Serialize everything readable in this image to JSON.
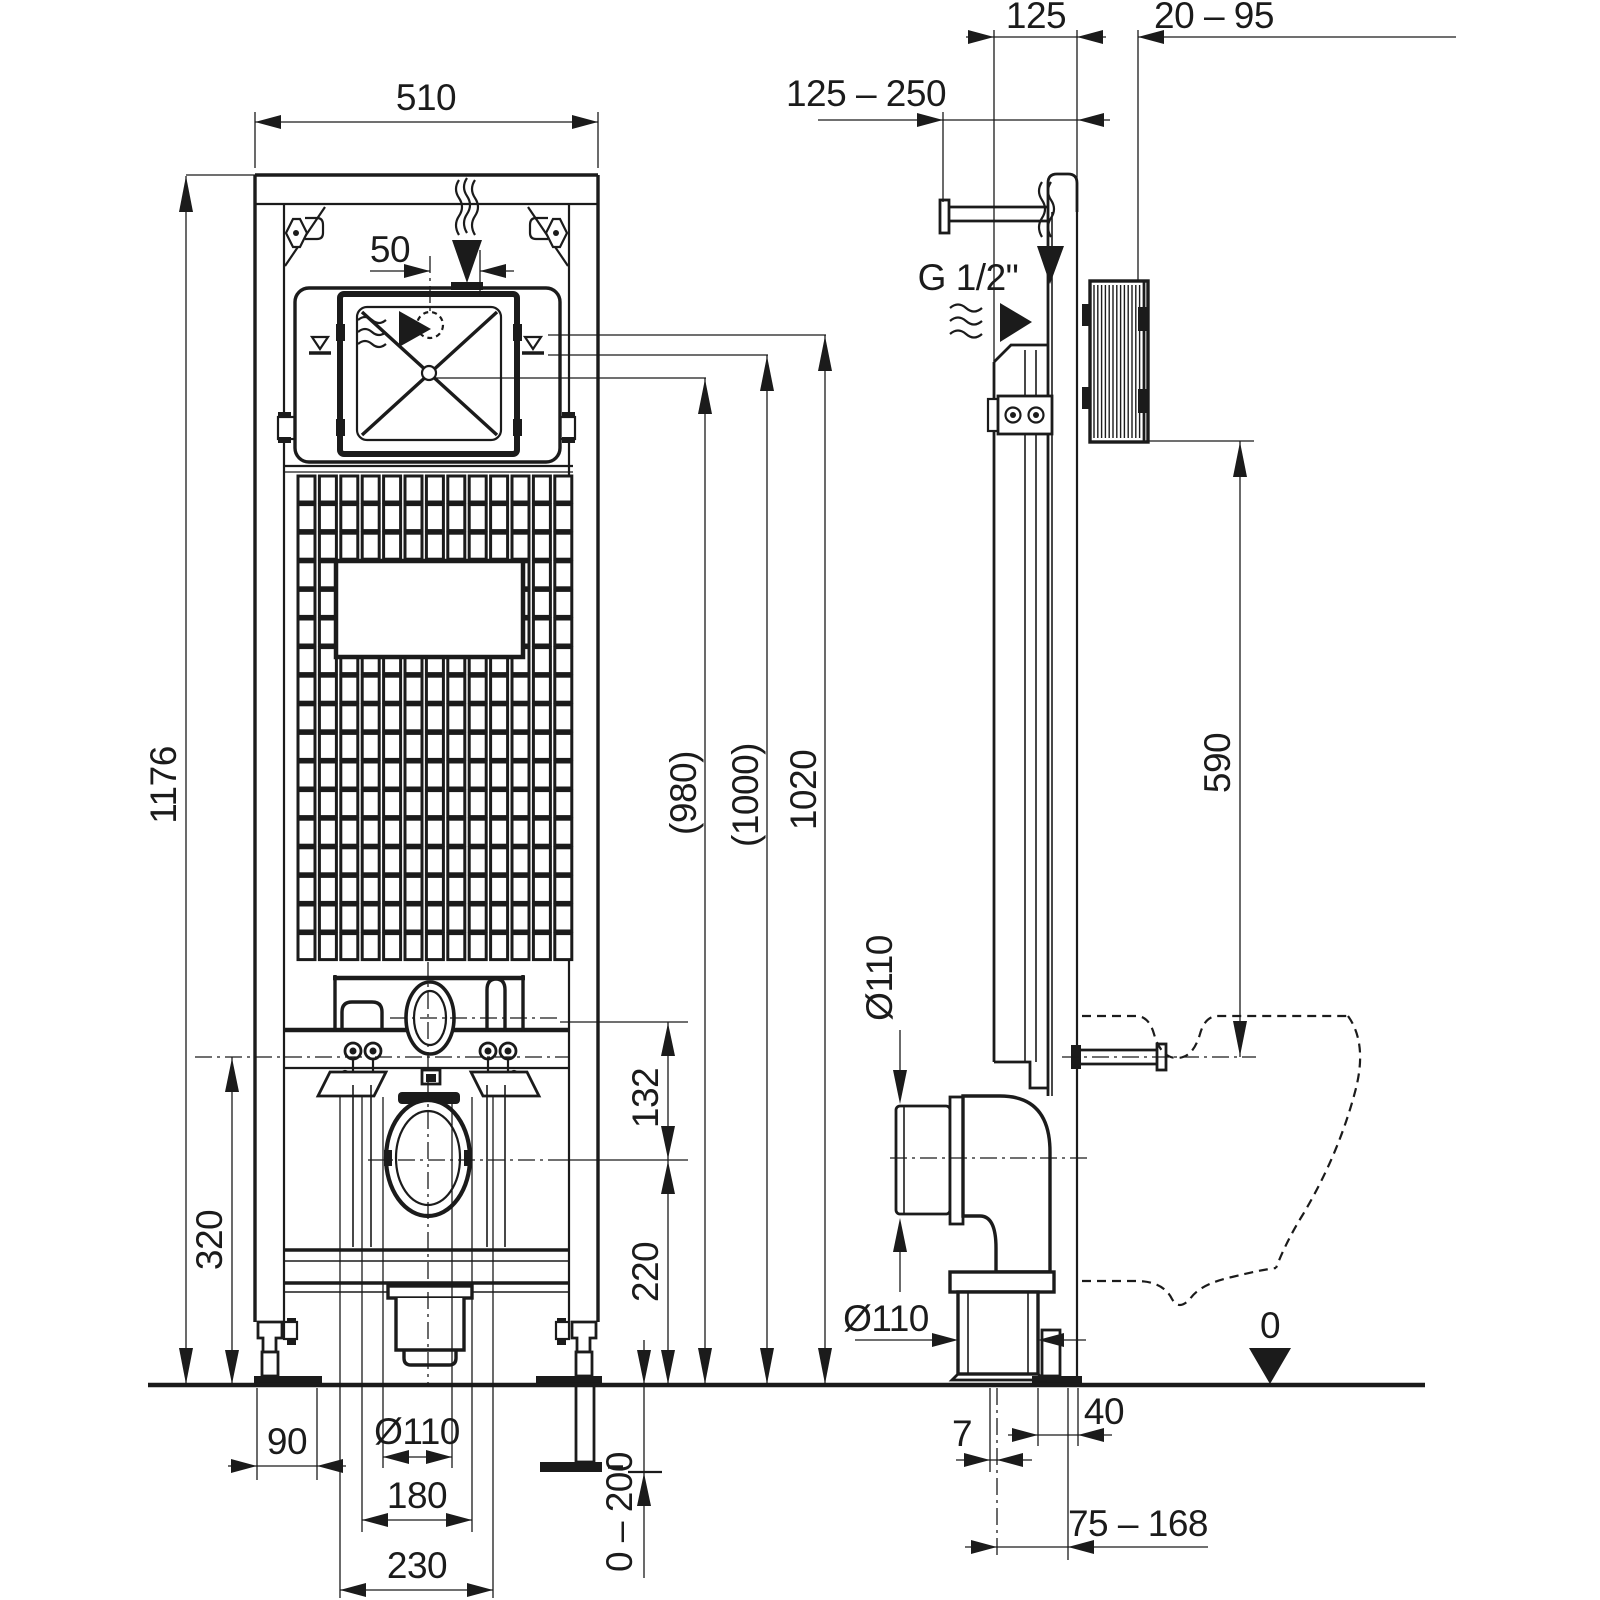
{
  "drawing": {
    "kind": "installation-frame technical drawing",
    "units": "mm",
    "front": {
      "width": "510",
      "inlet_offset": "50",
      "height": "1176",
      "h980": "(980)",
      "h1000": "(1000)",
      "h1020": "1020",
      "screw_axis_height": "320",
      "axis_gap": "132",
      "drain_axis_height": "220",
      "foot_plate": "90",
      "drain_dia": "Ø110",
      "spacing_180": "180",
      "spacing_230": "230",
      "foot_adjust": "0 – 200"
    },
    "side": {
      "supply_range": "125 – 250",
      "depth_125": "125",
      "wall_range": "20 – 95",
      "thread": "G 1/2\"",
      "box_height": "590",
      "drain_dia_vertical": "Ø110",
      "drain_dia_bottom": "Ø110",
      "floor_datum": "0",
      "dim_40": "40",
      "dim_7": "7",
      "outlet_range": "75 – 168"
    }
  }
}
